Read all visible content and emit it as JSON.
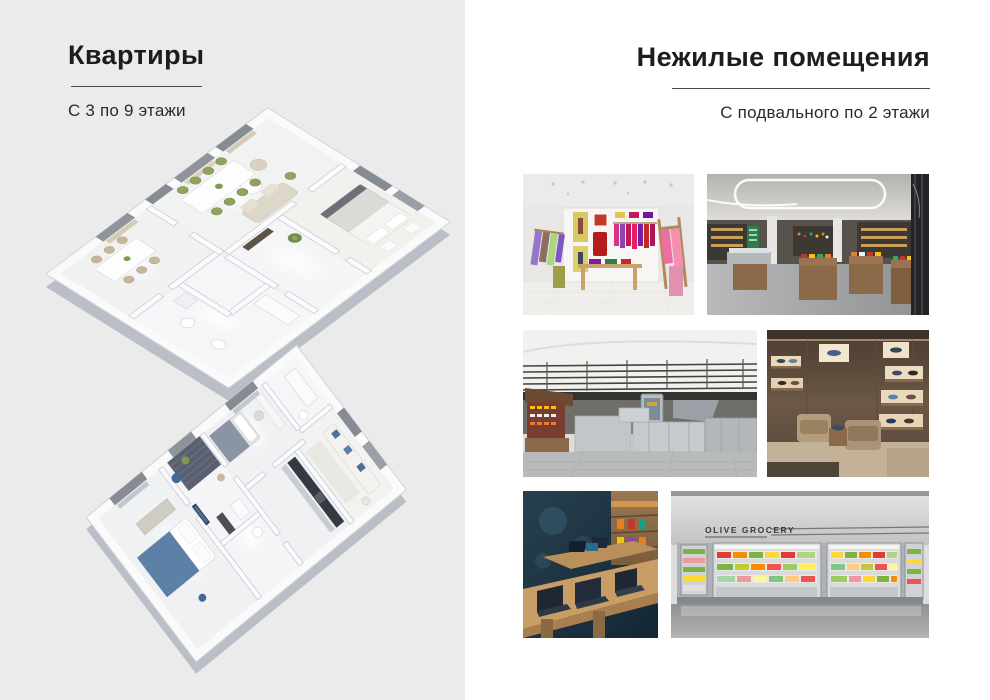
{
  "slide": {
    "left": {
      "title": "Квартиры",
      "subtitle": "С 3 по 9 этажи",
      "floorplans": [
        {
          "name": "apartment-floorplan-top",
          "accent": "#8fa35c"
        },
        {
          "name": "apartment-floorplan-bottom",
          "accent": "#5d80a6"
        }
      ]
    },
    "right": {
      "title": "Нежилые помещения",
      "subtitle": "С подвального по 2 этажи",
      "photos": [
        {
          "name": "clothing-boutique-photo"
        },
        {
          "name": "market-hall-photo"
        },
        {
          "name": "food-court-photo"
        },
        {
          "name": "shoe-store-photo"
        },
        {
          "name": "electronics-store-photo"
        },
        {
          "name": "grocery-fridge-wall-photo",
          "signage": "OLIVE GROCERY"
        }
      ]
    },
    "colors": {
      "left_bg": "#ebebeb",
      "right_bg": "#ffffff",
      "text": "#1d1d1d",
      "rule": "#4a4a4a"
    }
  }
}
